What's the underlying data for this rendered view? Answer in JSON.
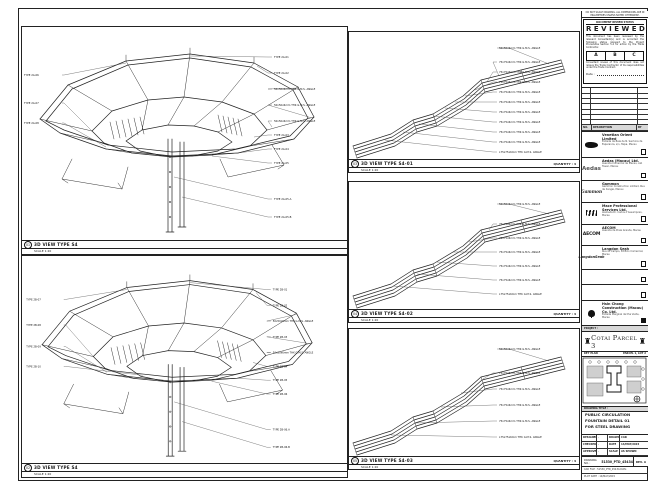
{
  "colors": {
    "line": "#1c1c1c",
    "panel_gray": "#d8d8d8",
    "paper": "#ffffff"
  },
  "titleblock": {
    "top_note": "DO NOT SCALE DRAWING. ALL DIMENSIONS ARE IN MILLIMETRES UNLESS NOTED OTHERWISE.",
    "stamp": {
      "head": "DOCUMENT REVIEW STATUS",
      "title": "REVIEWED",
      "para1": "This document has been reviewed by the relevant Consultant(s) and is accorded the following status relevant to the Project Procedures Section 5.4 for action by the Trade Contractor.",
      "options": [
        "A",
        "B",
        "C"
      ],
      "para2": "Consultant review of this document does not relieve the Trade Contractor of its responsibilities under the Trade Contract.",
      "date_label": "Date :"
    },
    "rev_table": {
      "headers": [
        "NO.",
        "DESCRIPTION",
        "BY"
      ]
    },
    "companies": [
      {
        "logo_text": "",
        "name": "Venetian Orient Limited",
        "address": "Estrada da Baia de N. Senhora da Esperanca, s/n, Taipa, Macau"
      },
      {
        "logo_text": "Aedas",
        "name": "Aedas (Macau) Ltd.",
        "address": "Avenida Comercial de Macau, AIA Tower, Macau"
      },
      {
        "logo_text": "Gammon",
        "name": "Gammon",
        "address": "Gammon Construction Limited, Rua de Xangai, Macau"
      },
      {
        "logo_text": "",
        "name": "Mace Professional Services Ltd.",
        "address": "Alameda Dr. Carlos d'Assumpcao, Macau"
      },
      {
        "logo_text": "AECOM",
        "name": "AECOM",
        "address": "Avenida da Praia Grande, Macau"
      },
      {
        "logo_text": "LangdonSeah",
        "name": "Langdon Seah",
        "address": "Rua do Campo, Edificio Comercial, Macau"
      },
      {
        "logo_text": "",
        "name": "",
        "address": ""
      },
      {
        "logo_text": "",
        "name": "",
        "address": ""
      },
      {
        "logo_text": "",
        "name": "Hsin Chong Construction (Macau) Co. Ltd.",
        "address": "Estrada Marginal da Ilha Verde, Macau"
      }
    ],
    "project_label": "PROJECT :",
    "project_name": "Cotai Parcel 3",
    "key_plan": {
      "label": "KEY PLAN",
      "parcel": "PARCEL 1, LOT 2"
    },
    "drawing_title": {
      "label": "DRAWING TITLE :",
      "lines": [
        "PUBLIC CIRCULATION",
        "FOUNTAIN DETAIL 01",
        "FOR STEEL DRAWING"
      ]
    },
    "fields": {
      "designed_label": "DESIGNED",
      "designed": "-",
      "checked_label": "CHECKED",
      "checked": "-",
      "approved_label": "APPROVED",
      "approved": "-",
      "drawn_label": "DRAWN",
      "drawn": "CAD",
      "date_label": "DATE",
      "date": "14/MAY/2015",
      "scale_label": "SCALE",
      "scale": "AS SHOWN"
    },
    "drawing_no": {
      "label": "DRAWING NO. :",
      "value": "51530_PTD_45434",
      "rev_label": "REV.",
      "rev": "A"
    },
    "cad_rows": [
      "CAD FILE : 51530_PTD_45434.DWG",
      "PLOT DATE : 14/MAY/2015"
    ]
  },
  "panels": [
    {
      "num": "01",
      "title": "3D VIEW TYPE S4",
      "scale": "SCALE 1:20",
      "labels_right": [
        "TYPE 2A-01",
        "TYPE 2A-02",
        "50x50x6mm THK G.M.S. ANGLE",
        "50x50x6mm THK G.M.S. ANGLE",
        "50x50x6mm THK G.M.S. ANGLE",
        "TYPE 2A-03",
        "TYPE 2A-04",
        "TYPE 2A-05",
        "TYPE 2A-05.A",
        "TYPE 2A-05.B"
      ],
      "labels_left": [
        "TYPE 2A-06",
        "TYPE 2A-07",
        "TYPE 2A-08"
      ]
    },
    {
      "num": "02",
      "title": "3D VIEW TYPE S4",
      "scale": "SCALE 1:20",
      "labels_right": [
        "TYPE 2B-01",
        "TYPE 2B-02",
        "50x50x6mm THK G.M.S. ANGLE",
        "TYPE 2B-03",
        "50x50x6mm THK G.M.S. ANGLE",
        "TYPE 2B-04",
        "TYPE 2B-05",
        "TYPE 2B-06",
        "TYPE 2B-06.A",
        "TYPE 2B-06.B"
      ],
      "labels_left": [
        "TYPE 2B-07",
        "TYPE 2B-08",
        "TYPE 2B-09",
        "TYPE 2B-10"
      ]
    },
    {
      "num": "03",
      "title": "3D VIEW TYPE S4-01",
      "scale": "SCALE 1:20",
      "quantity": "QUANTITY : 4",
      "labels": [
        "50x50x6mm THK G.M.S. ANGLE",
        "75x75x6mm THK G.M.S. ANGLE",
        "75x75x6mm THK G.M.S. ANGLE",
        "75x75x6mm THK G.M.S. ANGLE",
        "75x75x6mm THK G.M.S. ANGLE",
        "75x75x6mm THK G.M.S. ANGLE",
        "75x75x6mm THK G.M.S. ANGLE",
        "75x75x6mm THK G.M.S. ANGLE",
        "75x75x6mm THK G.M.S. ANGLE",
        "75x75x6mm THK G.M.S. ANGLE",
        "L75x75x6mm THK G.M.S. ANGLE"
      ]
    },
    {
      "num": "04",
      "title": "3D VIEW TYPE S4-02",
      "scale": "SCALE 1:20",
      "quantity": "QUANTITY : 4",
      "labels": [
        "50x50x6mm THK G.M.S. ANGLE",
        "75x75x6mm THK G.M.S. ANGLE",
        "75x75x6mm THK G.M.S. ANGLE",
        "75x75x6mm THK G.M.S. ANGLE",
        "75x75x6mm THK G.M.S. ANGLE",
        "75x75x6mm THK G.M.S. ANGLE",
        "L75x75x6mm THK G.M.S. ANGLE"
      ]
    },
    {
      "num": "05",
      "title": "3D VIEW TYPE S4-03",
      "scale": "SCALE 1:20",
      "quantity": "QUANTITY : 4",
      "labels": [
        "50x50x6mm THK G.M.S. ANGLE",
        "75x75x6mm THK G.M.S. ANGLE",
        "75x75x6mm THK G.M.S. ANGLE",
        "75x75x6mm THK G.M.S. ANGLE",
        "75x75x6mm THK G.M.S. ANGLE",
        "L75x75x6mm THK G.M.S. ANGLE"
      ]
    }
  ]
}
